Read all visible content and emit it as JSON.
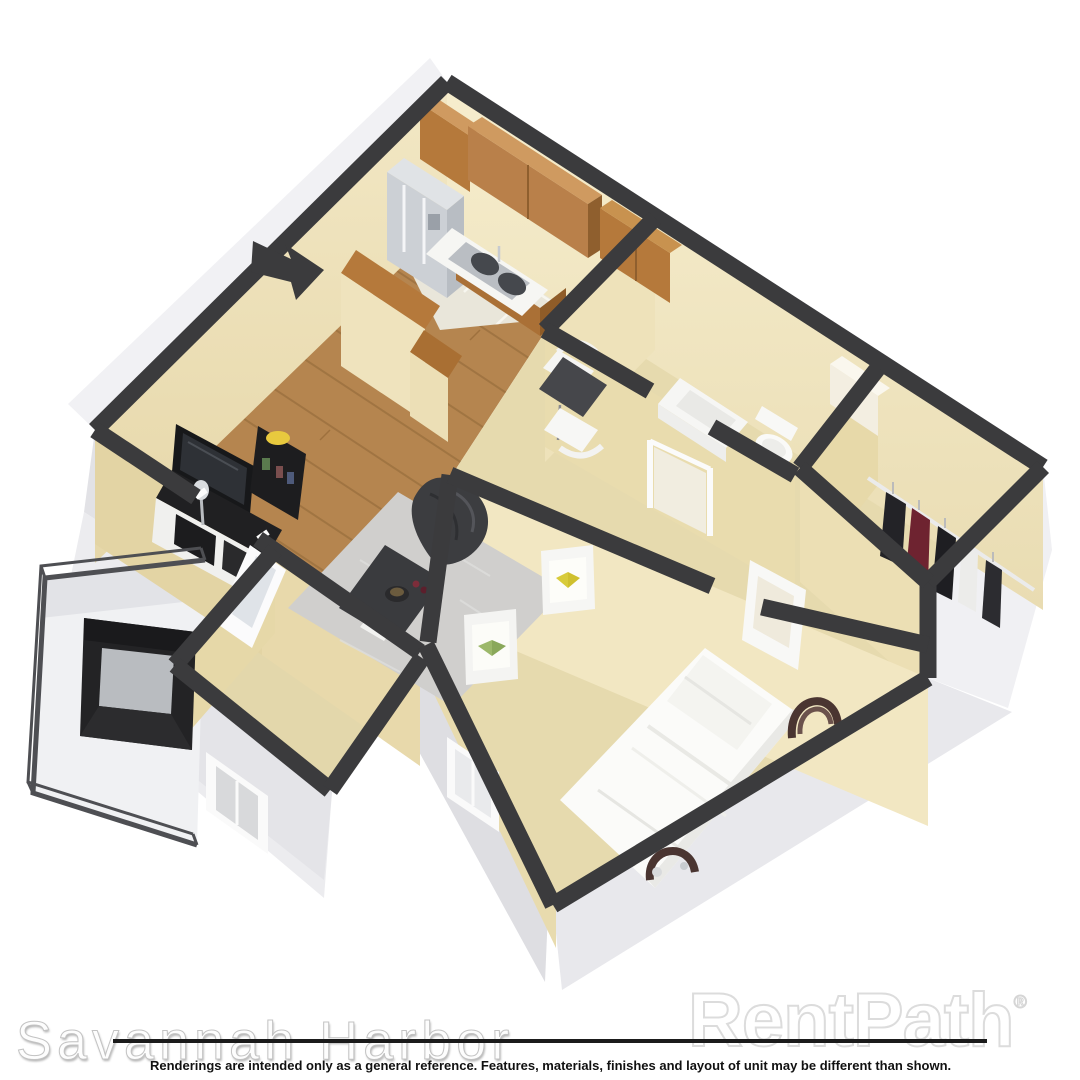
{
  "watermarks": {
    "property_name": "Savannah Harbor",
    "brand": "RentPath",
    "brand_registered": "®"
  },
  "disclaimer": "Renderings are intended only as a general reference. Features, materials, finishes and layout of unit may be different than shown.",
  "colors": {
    "wall_top_charcoal": "#3b3b3d",
    "wall_interior_cream": "#f0e5c1",
    "wall_interior_cream_shaded": "#e3d4a4",
    "wall_exterior_gray": "#ececef",
    "floor_wood": "#b5854f",
    "floor_tile": "#e9e6da",
    "floor_carpet_tan": "#e6daae",
    "rug_gray": "#d0cfcd",
    "cabinet_wood": "#b5793b",
    "counter_white": "#f6f6f3",
    "furniture_black": "#202022",
    "bed_white": "#fbfbf9",
    "headboard_brown": "#4a3531",
    "accent_red_clothing": "#6e2330"
  }
}
